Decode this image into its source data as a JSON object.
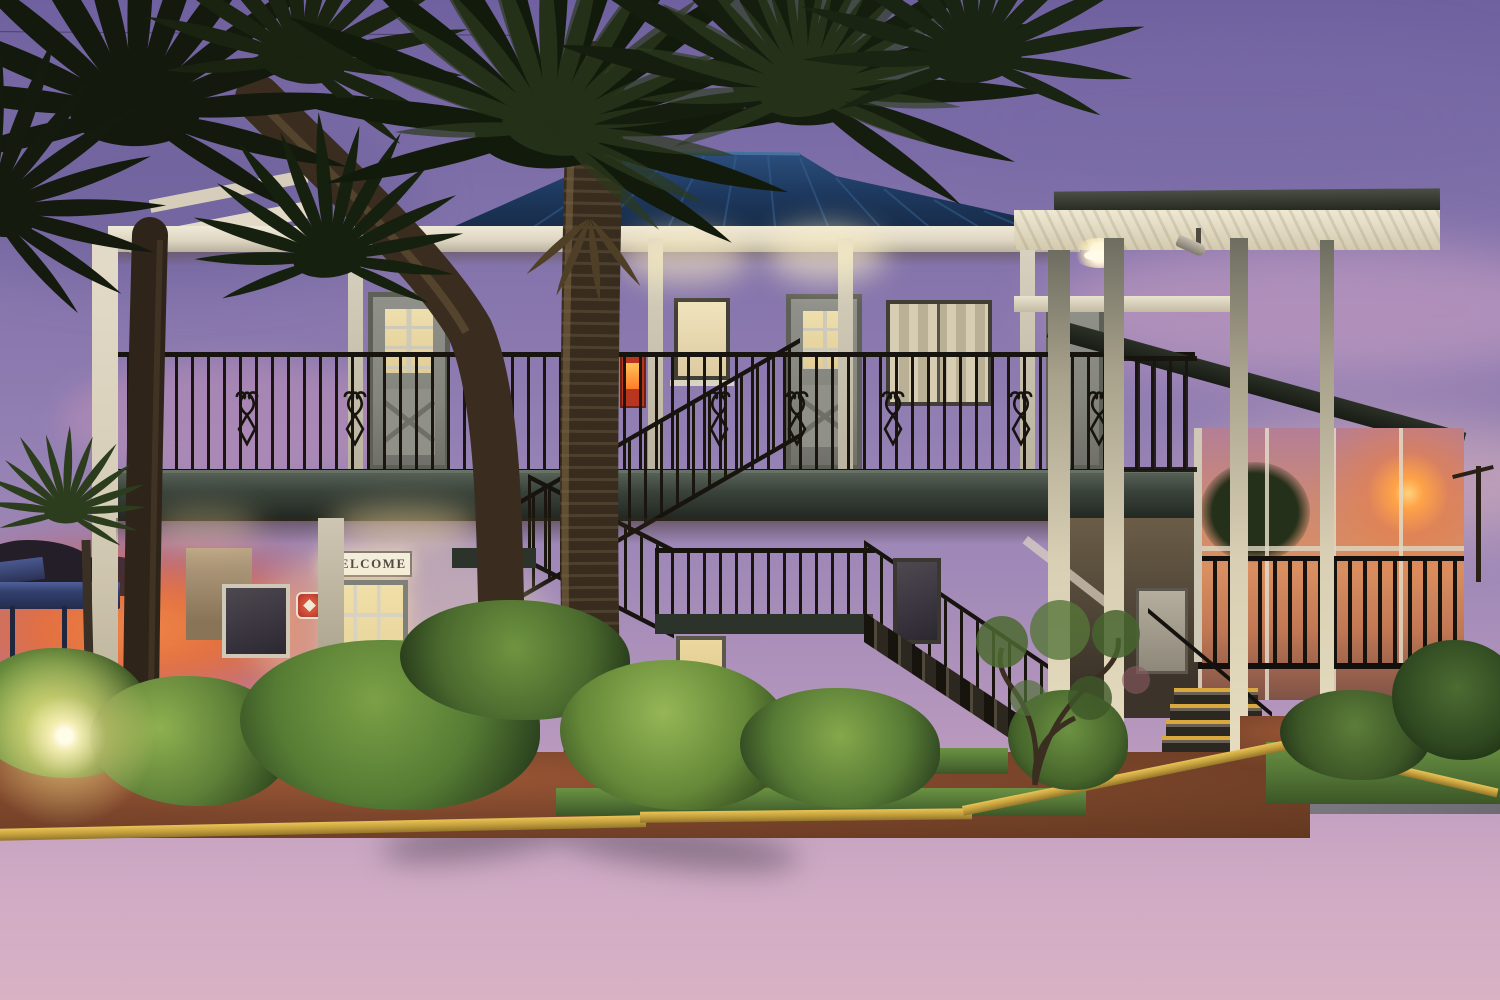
{
  "scene": {
    "signs": {
      "welcome": "WELCOME"
    },
    "objects": {
      "building": "two-story white brick motel office with blue metal hip roof",
      "time_of_day": "dusk with purple-pink sunset",
      "vehicle": "white SUV in side parking lot",
      "landscape": "palm trees, lit shrubs, red mulch, yellow curb, asphalt drive"
    },
    "palette": {
      "sky_top": "#6f619f",
      "sky_violet": "#8d7bb0",
      "sky_pink": "#d9b2c4",
      "sunset_orange": "#e4713d",
      "sun_glow": "#ffa348",
      "roof_metal_blue": "#1d3a60",
      "canopy_soffit": "#e9e2d0",
      "brick_lit": "#f3ead4",
      "fascia_dark": "#39423a",
      "railing_iron": "#17130e",
      "door_gray": "#84857d",
      "window_warm": "#ecd9a2",
      "alarm_red": "#b8351f",
      "curb_yellow": "#caa43e",
      "mulch_red": "#7c462c",
      "foliage_lit": "#9cc054",
      "foliage_dark": "#27391c",
      "asphalt_gray": "#4c4850",
      "palm_trunk": "#3a2f22",
      "suv_white": "#cdcfc9",
      "awning_blue": "#32406e"
    }
  }
}
